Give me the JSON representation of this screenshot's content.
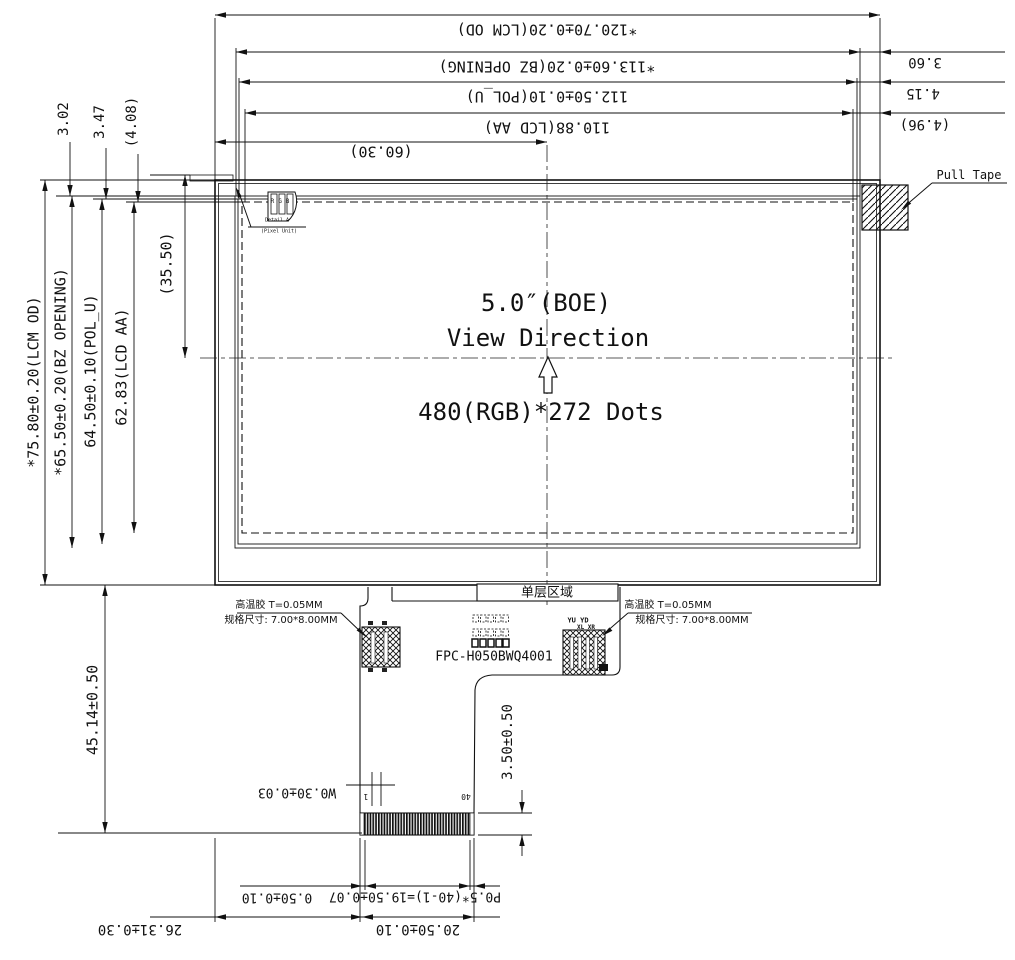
{
  "drawing": {
    "title": "5.0″(BOE)",
    "view_direction": "View Direction",
    "resolution": "480(RGB)*272 Dots",
    "pull_tape": "Pull Tape",
    "dims_top": {
      "lcm_od": "*120.70±0.20(LCM OD)",
      "bz_opening": "*113.60±0.20(BZ OPENING)",
      "pol_u": "112.50±0.10(POL_U)",
      "lcd_aa": "110.88(LCD AA)",
      "half_width": "(60.30)",
      "edge_bz": "3.60",
      "edge_pol": "4.15",
      "edge_aa": "(4.96)"
    },
    "dims_left": {
      "lcm_od": "*75.80±0.20(LCM OD)",
      "bz_opening": "*65.50±0.20(BZ OPENING)",
      "pol_u": "64.50±0.10(POL_U)",
      "lcd_aa": "62.83(LCD AA)",
      "half_height": "(35.50)",
      "edge_bz": "3.02",
      "edge_pol": "3.47",
      "edge_aa": "(4.08)"
    },
    "dims_bottom": {
      "fpc_length": "45.14±0.50",
      "stiffener": "3.50±0.50",
      "trace_width": "W0.30±0.03",
      "finger_margin": "0.50±0.10",
      "finger_pitch": "P0.5*(40-1)=19.50±0.07",
      "connector_width": "20.50±0.10",
      "tail_offset": "26.31±0.30",
      "pin_first": "1",
      "pin_last": "40"
    },
    "fpc": {
      "part_number": "FPC-H050BWQ4001",
      "single_layer_area": "单层区域",
      "glue_left": {
        "line1": "高温胶 T=0.05MM",
        "line2": "规格尺寸: 7.00*8.00MM"
      },
      "glue_right": {
        "line1": "高温胶 T=0.05MM",
        "line2": "规格尺寸: 7.00*8.00MM"
      },
      "touch_labels": {
        "row1": "YU YD",
        "row2": "XL XR"
      }
    },
    "pixel_detail": {
      "rgb": "RGB",
      "caption1": "Detail A",
      "caption2": "(Pixel Unit)"
    }
  }
}
